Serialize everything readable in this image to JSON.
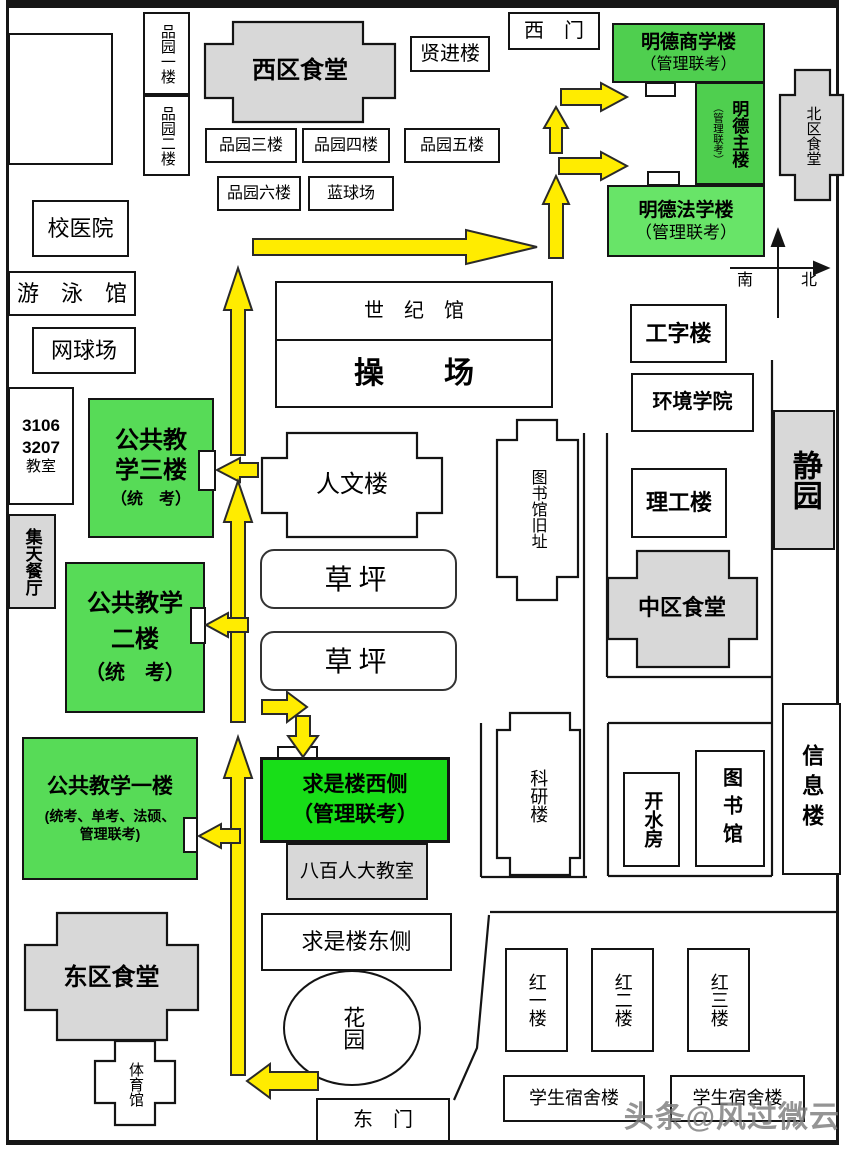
{
  "colors": {
    "green_medium": "#4FCF4F",
    "green_light": "#68E468",
    "green_mid": "#57DB57",
    "green_bright": "#18DE18",
    "gray_building": "#D8D8D8",
    "arrow_yellow": "#FFEC00",
    "line_black": "#141414"
  },
  "compass": {
    "south": "南",
    "north": "北"
  },
  "gates": {
    "west_gate": "西　门",
    "east_gate": "东　门"
  },
  "buildings": {
    "pinyuan1": "品园一楼",
    "pinyuan2": "品园二楼",
    "pinyuan3": "品园三楼",
    "pinyuan4": "品园四楼",
    "pinyuan5": "品园五楼",
    "pinyuan6": "品园六楼",
    "lanqiuchang": "蓝球场",
    "xiqu_canteen": "西区食堂",
    "xianjinlou": "贤进楼",
    "beiqu_canteen": "北区食堂",
    "xiaoyiyuan": "校医院",
    "youyongguan": "游　泳　馆",
    "wangqiuchang": "网球场",
    "classroom": {
      "l1": "3106",
      "l2": "3207",
      "l3": "教室"
    },
    "jitian_canting": "集天餐厅",
    "shijiguan": "世　纪　馆",
    "caochang": "操　　场",
    "renwenlou": "人文楼",
    "tushuguan_jiuzhi": "图书馆旧址",
    "caoping1": "草坪",
    "caoping2": "草坪",
    "gongzilou": "工字楼",
    "huanjing_xueyuan": "环境学院",
    "ligonglou": "理工楼",
    "jingyuan": "静园",
    "zhongqu_canteen": "中区食堂",
    "keyanlou": "科研楼",
    "kaishuifang": "开水房",
    "tushuguan": "图书馆",
    "xinxilou": "信息楼",
    "babairen_jiaoshi": "八百人大教室",
    "qiushi_east": "求是楼东侧",
    "huayuan": "花园",
    "dongqu_canteen": "东区食堂",
    "tiyuguan": "体育馆",
    "hong1": "红一楼",
    "hong2": "红二楼",
    "hong3": "红三楼",
    "sushe1": "学生宿舍楼",
    "sushe2": "学生宿舍楼"
  },
  "exam_sites": {
    "mingde_shangxue": {
      "name": "明德商学楼",
      "note": "（管理联考）"
    },
    "mingde_zhulou": {
      "name": "明德主楼",
      "note": "（管理联考）"
    },
    "mingde_faxue": {
      "name": "明德法学楼",
      "note": "（管理联考）"
    },
    "gongjiao3": {
      "l1": "公共教",
      "l2": "学三楼",
      "l3": "（统　考）"
    },
    "gongjiao2": {
      "l1": "公共教学",
      "l2": "二楼",
      "l3": "（统　考）"
    },
    "gongjiao1": {
      "l1": "公共教学一楼",
      "l2": "(统考、单考、法硕、",
      "l3": "管理联考)"
    },
    "qiushi_west": {
      "l1": "求是楼西侧",
      "l2": "（管理联考）"
    }
  },
  "watermark": "头条@风过微云"
}
